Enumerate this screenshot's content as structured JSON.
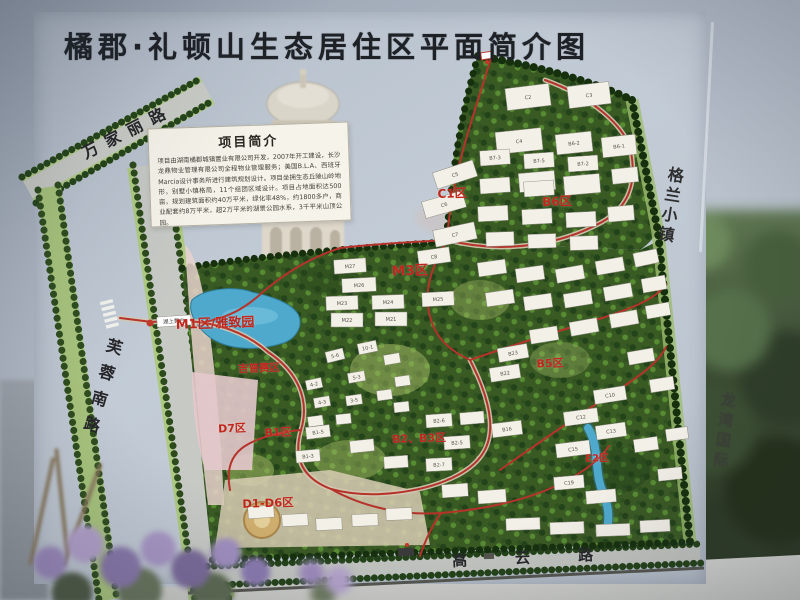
{
  "title": "橘郡·礼顿山生态居住区平面简介图",
  "info_box": {
    "heading": "项目简介",
    "body": "项目由湖南橘郡城镇置业有限公司开发，2007年开工建设，长沙龙鼎物业管理有限公司全程物业管理服务；美国B.L.A、西班牙Marcia设计事务所进行建筑规划设计。项目坐拥生态丘陵山岭地形，别墅小镇格局，11个组团区域设计。项目占地面积达500亩，规划建筑面积约40万平米，绿化率48%，约1800多户，商业配套约8万平米，超2万平米的湖景公园水系，3千平米山顶公园。"
  },
  "roads": [
    {
      "id": "wanjiali",
      "label": "万家丽路"
    },
    {
      "id": "furongnan",
      "label": "芙蓉南路"
    },
    {
      "id": "gaoyun",
      "label": "高云路"
    }
  ],
  "surroundings": [
    {
      "id": "gelan",
      "label": "格兰小镇"
    },
    {
      "id": "longwan",
      "label": "龙湾国际"
    }
  ],
  "zones": [
    {
      "id": "c1",
      "label": "C1区"
    },
    {
      "id": "b6",
      "label": "B6区"
    },
    {
      "id": "m3",
      "label": "M3区"
    },
    {
      "id": "m1",
      "label": "M1区/雅致园"
    },
    {
      "id": "gypsy",
      "label": "吉普赛区"
    },
    {
      "id": "b5",
      "label": "B5区"
    },
    {
      "id": "d7",
      "label": "D7区"
    },
    {
      "id": "b1",
      "label": "B1区"
    },
    {
      "id": "b2b3",
      "label": "B2、B3区"
    },
    {
      "id": "e2",
      "label": "E2区"
    },
    {
      "id": "d1d6",
      "label": "D1-D6区"
    }
  ],
  "poi": [
    {
      "id": "lake-stage",
      "label": "湖上舞台"
    }
  ],
  "colors": {
    "zone_red": "#c2271c",
    "road_red": "#b5332a",
    "map_green": "#3a5a24",
    "lake_blue": "#4fa9cd",
    "sign_bg": "#bdc6d1"
  },
  "buildings": [
    {
      "l": "C2",
      "x": 506,
      "y": 86,
      "w": 44,
      "h": 22,
      "r": -7
    },
    {
      "l": "C3",
      "x": 568,
      "y": 84,
      "w": 42,
      "h": 22,
      "r": -7
    },
    {
      "l": "C4",
      "x": 496,
      "y": 130,
      "w": 46,
      "h": 22,
      "r": -6
    },
    {
      "l": "B6-2",
      "x": 556,
      "y": 133,
      "w": 36,
      "h": 20,
      "r": -6
    },
    {
      "l": "B6-1",
      "x": 602,
      "y": 136,
      "w": 34,
      "h": 20,
      "r": -6
    },
    {
      "l": "",
      "x": 519,
      "y": 172,
      "w": 36,
      "h": 19,
      "r": -5
    },
    {
      "l": "",
      "x": 564,
      "y": 175,
      "w": 36,
      "h": 19,
      "r": -5
    },
    {
      "l": "C5",
      "x": 434,
      "y": 166,
      "w": 42,
      "h": 17,
      "r": -18
    },
    {
      "l": "C6",
      "x": 423,
      "y": 196,
      "w": 42,
      "h": 17,
      "r": -16
    },
    {
      "l": "C7",
      "x": 434,
      "y": 226,
      "w": 42,
      "h": 17,
      "r": -12
    },
    {
      "l": "B7-3",
      "x": 480,
      "y": 150,
      "w": 30,
      "h": 15,
      "r": -4
    },
    {
      "l": "B7-5",
      "x": 524,
      "y": 153,
      "w": 30,
      "h": 15,
      "r": -4
    },
    {
      "l": "B7-2",
      "x": 568,
      "y": 156,
      "w": 30,
      "h": 15,
      "r": -4
    },
    {
      "l": "",
      "x": 612,
      "y": 168,
      "w": 26,
      "h": 15,
      "r": -6
    },
    {
      "l": "",
      "x": 480,
      "y": 178,
      "w": 30,
      "h": 15,
      "r": -4
    },
    {
      "l": "",
      "x": 524,
      "y": 181,
      "w": 30,
      "h": 15,
      "r": -4
    },
    {
      "l": "",
      "x": 478,
      "y": 206,
      "w": 30,
      "h": 15,
      "r": -3
    },
    {
      "l": "",
      "x": 522,
      "y": 209,
      "w": 30,
      "h": 15,
      "r": -3
    },
    {
      "l": "",
      "x": 566,
      "y": 212,
      "w": 30,
      "h": 15,
      "r": -3
    },
    {
      "l": "",
      "x": 608,
      "y": 206,
      "w": 26,
      "h": 15,
      "r": -5
    },
    {
      "l": "",
      "x": 486,
      "y": 232,
      "w": 28,
      "h": 14,
      "r": -2
    },
    {
      "l": "",
      "x": 528,
      "y": 234,
      "w": 28,
      "h": 14,
      "r": -2
    },
    {
      "l": "",
      "x": 570,
      "y": 236,
      "w": 28,
      "h": 14,
      "r": -2
    },
    {
      "l": "C8",
      "x": 418,
      "y": 249,
      "w": 32,
      "h": 15,
      "r": -8
    },
    {
      "l": "M27",
      "x": 334,
      "y": 259,
      "w": 32,
      "h": 14,
      "r": -4
    },
    {
      "l": "M26",
      "x": 342,
      "y": 278,
      "w": 34,
      "h": 14,
      "r": -3
    },
    {
      "l": "M23",
      "x": 326,
      "y": 296,
      "w": 32,
      "h": 14,
      "r": -2
    },
    {
      "l": "M24",
      "x": 372,
      "y": 295,
      "w": 32,
      "h": 14,
      "r": -2
    },
    {
      "l": "M25",
      "x": 422,
      "y": 292,
      "w": 32,
      "h": 14,
      "r": -3
    },
    {
      "l": "M22",
      "x": 331,
      "y": 313,
      "w": 32,
      "h": 14,
      "r": 0
    },
    {
      "l": "M21",
      "x": 375,
      "y": 312,
      "w": 32,
      "h": 14,
      "r": 0
    },
    {
      "l": "",
      "x": 478,
      "y": 261,
      "w": 28,
      "h": 14,
      "r": -8
    },
    {
      "l": "",
      "x": 516,
      "y": 267,
      "w": 28,
      "h": 14,
      "r": -8
    },
    {
      "l": "",
      "x": 556,
      "y": 267,
      "w": 28,
      "h": 14,
      "r": -10
    },
    {
      "l": "",
      "x": 596,
      "y": 259,
      "w": 28,
      "h": 14,
      "r": -10
    },
    {
      "l": "",
      "x": 634,
      "y": 251,
      "w": 24,
      "h": 14,
      "r": -12
    },
    {
      "l": "",
      "x": 486,
      "y": 291,
      "w": 28,
      "h": 14,
      "r": -8
    },
    {
      "l": "",
      "x": 524,
      "y": 295,
      "w": 28,
      "h": 14,
      "r": -8
    },
    {
      "l": "",
      "x": 564,
      "y": 292,
      "w": 28,
      "h": 14,
      "r": -9
    },
    {
      "l": "",
      "x": 604,
      "y": 285,
      "w": 28,
      "h": 14,
      "r": -10
    },
    {
      "l": "",
      "x": 642,
      "y": 277,
      "w": 24,
      "h": 14,
      "r": -10
    },
    {
      "l": "",
      "x": 530,
      "y": 328,
      "w": 28,
      "h": 14,
      "r": -9
    },
    {
      "l": "",
      "x": 570,
      "y": 320,
      "w": 28,
      "h": 14,
      "r": -10
    },
    {
      "l": "",
      "x": 610,
      "y": 312,
      "w": 28,
      "h": 14,
      "r": -10
    },
    {
      "l": "",
      "x": 646,
      "y": 304,
      "w": 24,
      "h": 13,
      "r": -10
    },
    {
      "l": "B23",
      "x": 498,
      "y": 346,
      "w": 30,
      "h": 14,
      "r": -10
    },
    {
      "l": "B22",
      "x": 490,
      "y": 366,
      "w": 30,
      "h": 14,
      "r": -9
    },
    {
      "l": "B16",
      "x": 492,
      "y": 422,
      "w": 30,
      "h": 14,
      "r": -7
    },
    {
      "l": "C10",
      "x": 594,
      "y": 388,
      "w": 32,
      "h": 14,
      "r": -9
    },
    {
      "l": "C12",
      "x": 564,
      "y": 410,
      "w": 34,
      "h": 14,
      "r": -8
    },
    {
      "l": "C13",
      "x": 596,
      "y": 424,
      "w": 30,
      "h": 14,
      "r": -8
    },
    {
      "l": "C15",
      "x": 556,
      "y": 442,
      "w": 34,
      "h": 14,
      "r": -7
    },
    {
      "l": "",
      "x": 628,
      "y": 350,
      "w": 26,
      "h": 13,
      "r": -10
    },
    {
      "l": "",
      "x": 650,
      "y": 378,
      "w": 24,
      "h": 13,
      "r": -9
    },
    {
      "l": "",
      "x": 634,
      "y": 438,
      "w": 24,
      "h": 13,
      "r": -8
    },
    {
      "l": "10-1",
      "x": 358,
      "y": 342,
      "w": 19,
      "h": 11,
      "r": -12
    },
    {
      "l": "5-6",
      "x": 326,
      "y": 350,
      "w": 18,
      "h": 11,
      "r": -14
    },
    {
      "l": "5-3",
      "x": 348,
      "y": 372,
      "w": 17,
      "h": 10,
      "r": -10
    },
    {
      "l": "4-2",
      "x": 306,
      "y": 379,
      "w": 16,
      "h": 10,
      "r": -12
    },
    {
      "l": "4-3",
      "x": 314,
      "y": 397,
      "w": 16,
      "h": 10,
      "r": -10
    },
    {
      "l": "3-5",
      "x": 346,
      "y": 395,
      "w": 16,
      "h": 10,
      "r": -8
    },
    {
      "l": "",
      "x": 384,
      "y": 354,
      "w": 16,
      "h": 10,
      "r": -10
    },
    {
      "l": "",
      "x": 395,
      "y": 376,
      "w": 15,
      "h": 10,
      "r": -8
    },
    {
      "l": "",
      "x": 377,
      "y": 390,
      "w": 15,
      "h": 10,
      "r": -8
    },
    {
      "l": "",
      "x": 394,
      "y": 402,
      "w": 15,
      "h": 10,
      "r": -6
    },
    {
      "l": "",
      "x": 336,
      "y": 414,
      "w": 15,
      "h": 10,
      "r": -6
    },
    {
      "l": "",
      "x": 308,
      "y": 416,
      "w": 15,
      "h": 10,
      "r": -8
    },
    {
      "l": "B2-6",
      "x": 426,
      "y": 414,
      "w": 26,
      "h": 13,
      "r": -4
    },
    {
      "l": "B2-5",
      "x": 444,
      "y": 436,
      "w": 26,
      "h": 13,
      "r": -4
    },
    {
      "l": "B2-7",
      "x": 426,
      "y": 458,
      "w": 26,
      "h": 13,
      "r": -3
    },
    {
      "l": "B1-5",
      "x": 306,
      "y": 426,
      "w": 24,
      "h": 12,
      "r": -7
    },
    {
      "l": "B1-3",
      "x": 296,
      "y": 450,
      "w": 24,
      "h": 12,
      "r": -5
    },
    {
      "l": "",
      "x": 350,
      "y": 440,
      "w": 24,
      "h": 12,
      "r": -6
    },
    {
      "l": "",
      "x": 384,
      "y": 456,
      "w": 24,
      "h": 12,
      "r": -4
    },
    {
      "l": "",
      "x": 460,
      "y": 412,
      "w": 24,
      "h": 12,
      "r": -5
    },
    {
      "l": "",
      "x": 248,
      "y": 506,
      "w": 26,
      "h": 12,
      "r": -4
    },
    {
      "l": "",
      "x": 282,
      "y": 514,
      "w": 26,
      "h": 12,
      "r": -3
    },
    {
      "l": "",
      "x": 316,
      "y": 518,
      "w": 26,
      "h": 12,
      "r": -3
    },
    {
      "l": "",
      "x": 352,
      "y": 514,
      "w": 26,
      "h": 12,
      "r": -2
    },
    {
      "l": "",
      "x": 386,
      "y": 508,
      "w": 26,
      "h": 12,
      "r": -2
    },
    {
      "l": "C19",
      "x": 554,
      "y": 476,
      "w": 30,
      "h": 13,
      "r": -5
    },
    {
      "l": "",
      "x": 586,
      "y": 490,
      "w": 30,
      "h": 13,
      "r": -5
    },
    {
      "l": "",
      "x": 478,
      "y": 490,
      "w": 28,
      "h": 13,
      "r": -4
    },
    {
      "l": "",
      "x": 442,
      "y": 484,
      "w": 26,
      "h": 13,
      "r": -4
    },
    {
      "l": "",
      "x": 506,
      "y": 518,
      "w": 34,
      "h": 12,
      "r": -2
    },
    {
      "l": "",
      "x": 550,
      "y": 522,
      "w": 34,
      "h": 12,
      "r": -2
    },
    {
      "l": "",
      "x": 596,
      "y": 524,
      "w": 34,
      "h": 12,
      "r": -2
    },
    {
      "l": "",
      "x": 640,
      "y": 520,
      "w": 30,
      "h": 12,
      "r": -3
    },
    {
      "l": "",
      "x": 658,
      "y": 468,
      "w": 24,
      "h": 12,
      "r": -6
    },
    {
      "l": "",
      "x": 666,
      "y": 428,
      "w": 22,
      "h": 12,
      "r": -8
    }
  ]
}
